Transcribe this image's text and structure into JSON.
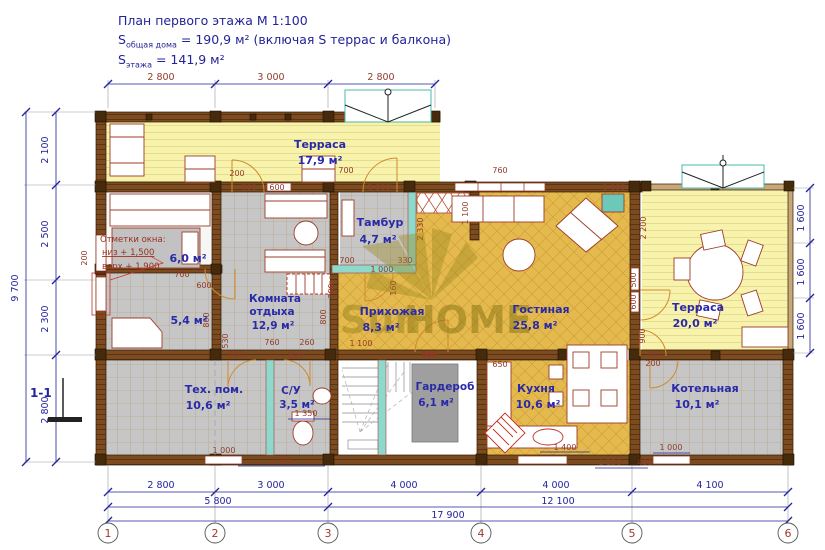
{
  "title": {
    "line1": "План первого этажа М 1:100",
    "s_total_prefix": "S",
    "s_total_sub": "общая дома",
    "s_total_value": " = 190,9 м² (включая S террас и балкона)",
    "s_floor_prefix": "S",
    "s_floor_sub": "этажа",
    "s_floor_value": " = 141,9 м²"
  },
  "watermark": {
    "part1": "Sun",
    "part2": "HOME"
  },
  "section_mark": "1-1",
  "window_note": {
    "line1": "Отметки окна:",
    "line2": "низ + 1,500",
    "line3": "верх + 1,900"
  },
  "rooms": {
    "terrace_top": {
      "name": "Терраса",
      "area": "17,9 м²"
    },
    "tambour": {
      "name": "Тамбур",
      "area": "4,7 м²"
    },
    "room_6": {
      "area": "6,0 м²"
    },
    "room_5_4": {
      "area": "5,4 м²"
    },
    "lounge": {
      "name1": "Комната",
      "name2": "отдыха",
      "area": "12,9 м²"
    },
    "hallway": {
      "name": "Прихожая",
      "area": "8,3 м²"
    },
    "living": {
      "name": "Гостиная",
      "area": "25,8 м²"
    },
    "terrace_right": {
      "name": "Терраса",
      "area": "20,0 м²"
    },
    "tech": {
      "name": "Тех. пом.",
      "area": "10,6 м²"
    },
    "wc": {
      "name": "С/У",
      "area": "3,5 м²"
    },
    "wardrobe": {
      "name": "Гардероб",
      "area": "6,1 м²"
    },
    "kitchen": {
      "name": "Кухня",
      "area": "10,6 м²"
    },
    "boiler": {
      "name": "Котельная",
      "area": "10,1 м²"
    }
  },
  "dimensions": {
    "top": [
      "2 800",
      "3 000",
      "2 800"
    ],
    "left": [
      "2 100",
      "2 500",
      "2 300",
      "2 800"
    ],
    "left_total": "9 700",
    "right": [
      "1 600",
      "1 600",
      "1 600"
    ],
    "bottom_row1": [
      "2 800",
      "3 000",
      "4 000",
      "4 000",
      "4 100"
    ],
    "bottom_row2_left": "5 800",
    "bottom_row2_right": "12 100",
    "bottom_total": "17 900",
    "interior": {
      "d200_terrace": "200",
      "d900_door": "900",
      "d600_win": "600",
      "d700_tdoor": "700",
      "d1000_tdoor": "1 000",
      "d700_room6": "700",
      "d600_room6": "600",
      "d760_lounge": "760",
      "d260_lounge": "260",
      "d800_lounge_l": "800",
      "d530_lounge_l": "530",
      "d800_lounge_r": "800",
      "d700_tamb": "700",
      "d330_tamb": "330",
      "d1000_tamb": "1 000",
      "d160": "160",
      "d780": "780",
      "d2330": "2 330",
      "d1100_v": "1 100",
      "d1100_hall": "1 100",
      "d900_hall": "900",
      "d760_living": "760",
      "d2000_living": "2 000",
      "d2200_terrace": "2 200",
      "d500_wall": "500",
      "d600_wall": "600",
      "d900_wall": "900",
      "d700_wall": "700",
      "d200_boiler": "200",
      "d800_tech": "800",
      "d800_wc": "800",
      "d1350_wc": "1 350",
      "d1000_tech": "1 000",
      "d1900_wc": "1 900",
      "d900_ward": "900",
      "d650_kitchen": "650",
      "d1400_kitchen": "1 400",
      "d1150": "1 150",
      "d400": "400",
      "d1000_boiler": "1 000",
      "d200_window": "200"
    }
  },
  "axes": [
    "1",
    "2",
    "3",
    "4",
    "5",
    "6"
  ]
}
